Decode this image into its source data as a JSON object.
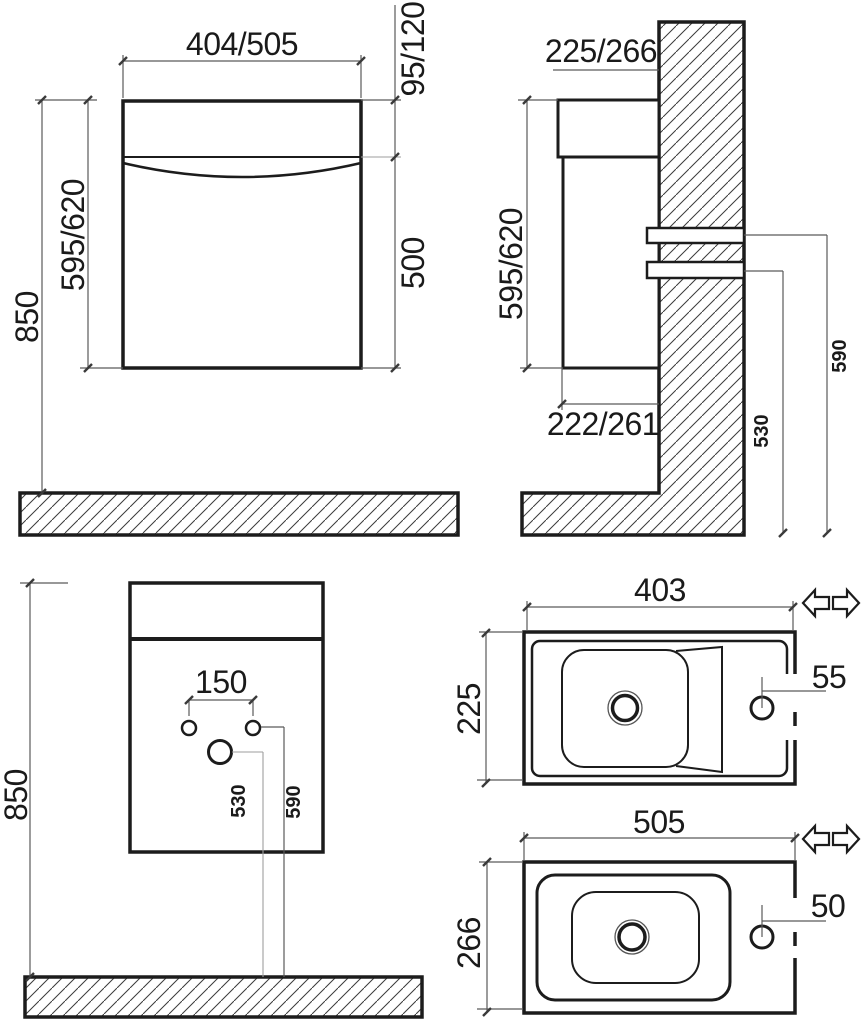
{
  "drawing_type": "vanity-unit-installation-drawing",
  "units": "mm",
  "colors": {
    "background": "#ffffff",
    "outline": "#1c1c1c",
    "dimension_lines": "#5a5a5a",
    "hatch": "#3a3a3a"
  },
  "icons": {
    "reversible": "double-arrow-left-right"
  },
  "views": {
    "front": {
      "width": "404/505",
      "top_height": "95/120",
      "height": "595/620",
      "door_height": "500",
      "wall_height": "850"
    },
    "side": {
      "depth": "225/266",
      "height": "595/620",
      "bottom_depth": "222/261",
      "bracket_top_height": "590",
      "bracket_bottom_height": "530"
    },
    "rear": {
      "hole_spacing": "150",
      "drain_height": "530",
      "hole_height": "590",
      "wall_height": "850"
    },
    "sink_small": {
      "width": "403",
      "depth": "225",
      "faucet_offset": "55"
    },
    "sink_large": {
      "width": "505",
      "depth": "266",
      "faucet_offset": "50"
    }
  }
}
